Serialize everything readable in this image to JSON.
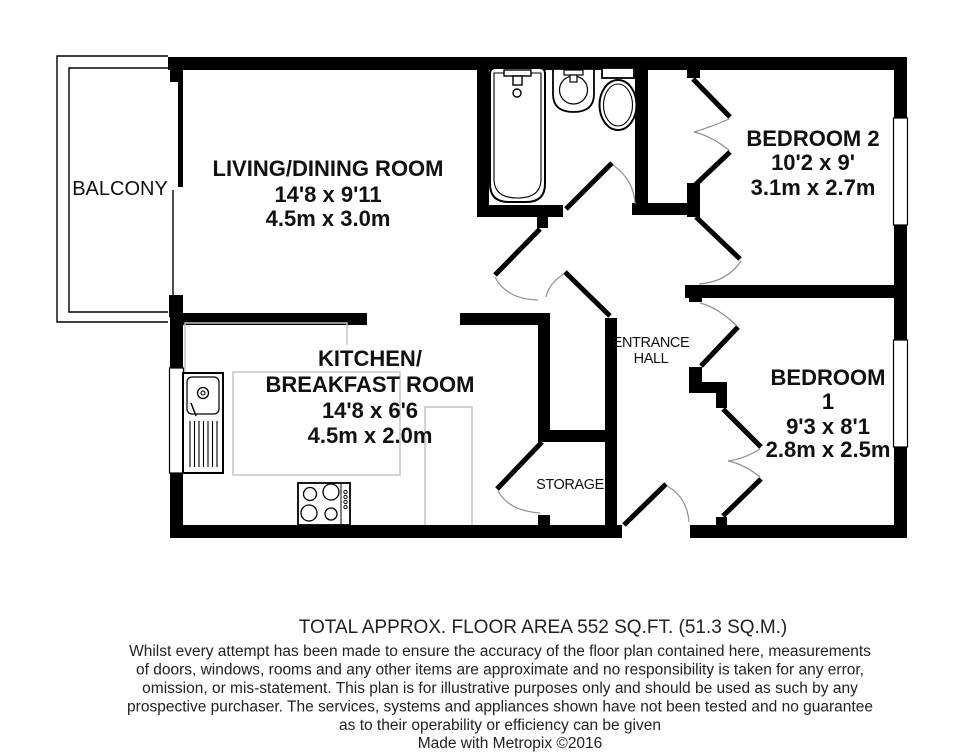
{
  "rooms": {
    "living": {
      "name": "LIVING/DINING ROOM",
      "imperial": "14'8 x 9'11",
      "metric": "4.5m x 3.0m"
    },
    "kitchen": {
      "name_line1": "KITCHEN/",
      "name_line2": "BREAKFAST ROOM",
      "imperial": "14'8 x 6'6",
      "metric": "4.5m x 2.0m"
    },
    "bedroom2": {
      "name": "BEDROOM 2",
      "imperial": "10'2 x 9'",
      "metric": "3.1m x 2.7m"
    },
    "bedroom1": {
      "name_line1": "BEDROOM",
      "name_line2": "1",
      "imperial": "9'3 x 8'1",
      "metric": "2.8m x 2.5m"
    },
    "hall": {
      "name_line1": "ENTRANCE",
      "name_line2": "HALL"
    },
    "storage": {
      "name": "STORAGE"
    },
    "balcony": {
      "name": "BALCONY"
    }
  },
  "fixtures": {
    "bath": "bath-icon",
    "basin": "basin-icon",
    "toilet": "toilet-icon",
    "kitchen_sink": "kitchen-sink-icon",
    "hob": "hob-icon"
  },
  "footer": {
    "area_title": "TOTAL APPROX. FLOOR AREA 552 SQ.FT. (51.3 SQ.M.)",
    "disclaimer_lines": [
      "Whilst every attempt has been made to ensure the accuracy of the floor plan contained here, measurements",
      "of doors, windows, rooms and any other items are approximate and no responsibility is taken for any error,",
      "omission, or mis-statement. This plan is for illustrative purposes only and should be used as such by any",
      "prospective purchaser. The services, systems and appliances shown have not been tested and no guarantee",
      "as to their operability or efficiency can be given"
    ],
    "credit": "Made with Metropix ©2016"
  },
  "colors": {
    "wall": "#000000",
    "text": "#111111",
    "door_arc": "#8f8f8f",
    "counter_outline": "#c2c2c2",
    "background": "#ffffff"
  }
}
